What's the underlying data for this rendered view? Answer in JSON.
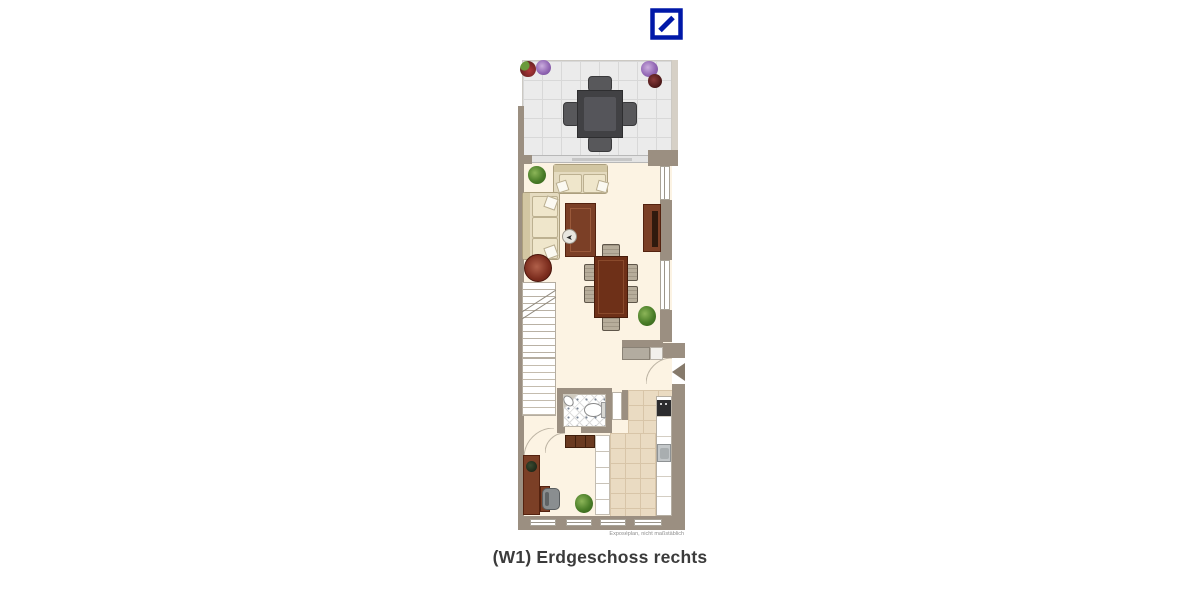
{
  "header": {
    "logo_name": "deutsche-bank-logo",
    "logo_color": "#0018A8"
  },
  "plan": {
    "disclaimer": "Exposéplan, nicht maßstäblich",
    "colors": {
      "wall": "#9b8f81",
      "wall_light": "#d6d0c6",
      "floor": "#fcf3e3",
      "terrace_tile": "#ebebeb",
      "terrace_grid": "#d8d8d8",
      "kitchen_tile": "#eadbc2",
      "kitchen_grid": "#d8c5a8",
      "wood": "#7b3f26",
      "wood_dark": "#54220f",
      "sofa": "#e5dbc0",
      "sofa_edge": "#ac9f7e",
      "chair": "#b7ad9b",
      "logo": "#0018A8",
      "text_dark": "#3b3b3b",
      "text_muted": "#8f8f8f"
    },
    "rooms": [
      "terrace",
      "living-room",
      "dining-area",
      "stairs",
      "hall",
      "bathroom",
      "kitchen",
      "work-corner"
    ],
    "furniture": [
      "patio-table",
      "patio-chairs",
      "flower-pots",
      "loveseat-sofa",
      "corner-sofa",
      "coffee-table",
      "compass-arrow",
      "sideboard",
      "round-side-table",
      "staircase",
      "dining-table",
      "dining-chairs",
      "plants",
      "wall-shelf",
      "entrance-arrow",
      "bathroom-sink",
      "toilet",
      "dresser",
      "tall-cabinet",
      "kitchen-counter",
      "oven",
      "kitchen-sink",
      "desk",
      "office-chair",
      "windows"
    ]
  },
  "caption": "(W1) Erdgeschoss rechts"
}
